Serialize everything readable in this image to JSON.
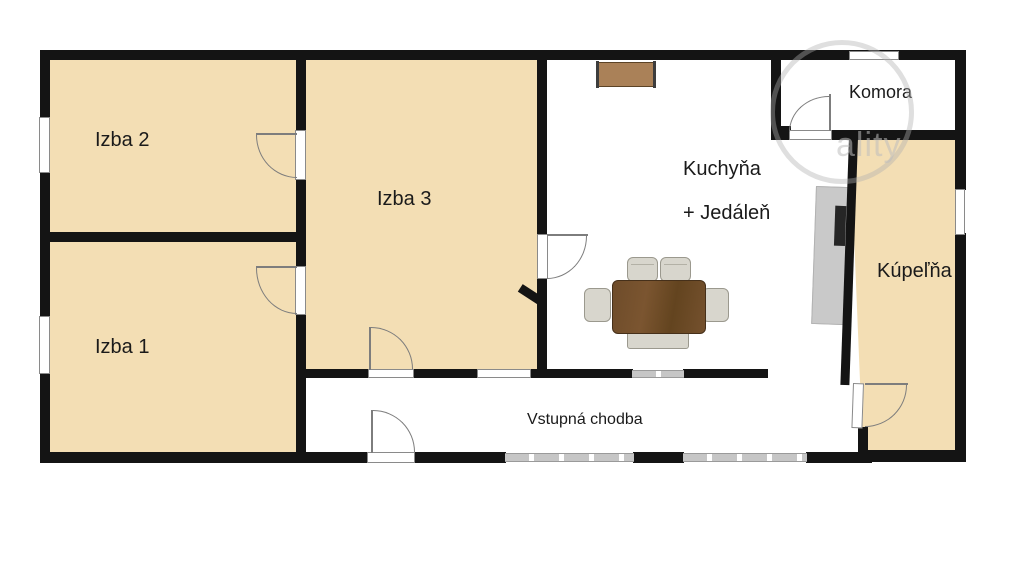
{
  "plan": {
    "rooms": {
      "izba2": {
        "label": "Izba 2"
      },
      "izba1": {
        "label": "Izba 1"
      },
      "izba3": {
        "label": "Izba 3"
      },
      "kitchen": {
        "label_line1": "Kuchyňa",
        "label_line2": "+ Jedáleň"
      },
      "komora": {
        "label": "Komora"
      },
      "kupelna": {
        "label": "Kúpeľňa"
      },
      "chodba": {
        "label": "Vstupná chodba"
      }
    },
    "watermark": "ality",
    "colors": {
      "room_fill": "#F3DEB4",
      "wall": "#141414",
      "window_gray": "#C6C6C6",
      "table_wood": "#6F4E2D",
      "sideboard_wood": "#AA8158",
      "chair": "#D8D6CD",
      "counter": "#C9C9C9"
    }
  }
}
